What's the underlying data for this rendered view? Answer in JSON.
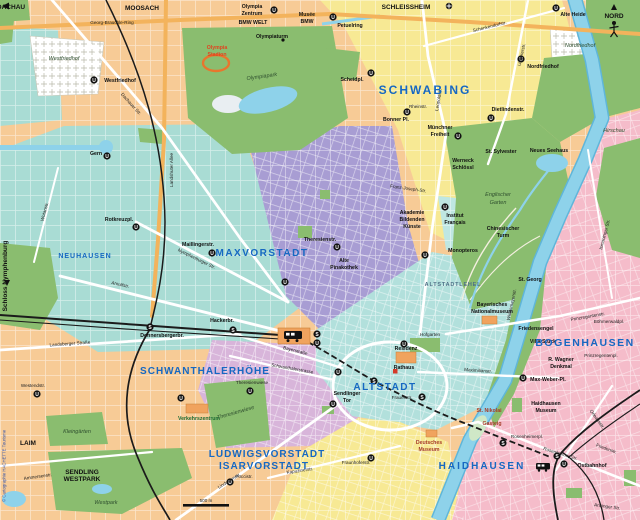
{
  "map": {
    "attribution": "© Cartographie HACHETTE Tourisme",
    "scale_label": "500 m",
    "compass_label": "NORD",
    "glyphs": {
      "u": "U",
      "s": "S"
    },
    "colors": {
      "base": "#f7cb96",
      "teal": "#a9dcd4",
      "cyan": "#b2e0dc",
      "purple": "#a89dd3",
      "yellow": "#f7e994",
      "pink": "#f5bcca",
      "lavender": "#d8b5da",
      "park": "#8abd6f",
      "water": "#8ed2ea",
      "rail": "#1b1b1b",
      "road_ring": "#f3b35c",
      "district_label": "#1668c2",
      "poi_red": "#e04420",
      "museum_red": "#a53c28"
    },
    "district_labels": [
      {
        "text": "MAXVORSTADT"
      },
      {
        "text": "SCHWABING"
      },
      {
        "text": "ALTSTADT"
      },
      {
        "text": "SCHWANTHALERHÖHE"
      },
      {
        "text": "LUDWIGSVORSTADT"
      },
      {
        "text": "ISARVORSTADT"
      },
      {
        "text": "HAIDHAUSEN"
      },
      {
        "text": "BOGENHAUSEN"
      },
      {
        "text": "NEUHAUSEN"
      },
      {
        "text": "ALTSTADTLEHEL"
      }
    ],
    "area_labels": [
      {
        "text": "MOOSACH"
      },
      {
        "text": "DACHAU"
      },
      {
        "text": "SCHLEISSHEIM"
      },
      {
        "text": "LAIM"
      },
      {
        "text": "SENDLING"
      },
      {
        "text": "WESTPARK"
      },
      {
        "text": "Westfriedhof"
      },
      {
        "text": "Nordfriedhof"
      },
      {
        "text": "Olympiapark"
      },
      {
        "text": "Englischer"
      },
      {
        "text": "Garten"
      },
      {
        "text": "Hirschau"
      },
      {
        "text": "Westpark"
      },
      {
        "text": "Kleingärten"
      },
      {
        "text": "Theresienwiese"
      },
      {
        "text": "Hofgarten"
      },
      {
        "text": "Schloss Nymphenburg"
      }
    ],
    "poi_labels": [
      {
        "text": "Olympia"
      },
      {
        "text": "Zentrum"
      },
      {
        "text": "BMW WELT"
      },
      {
        "text": "Musée"
      },
      {
        "text": "BMW"
      },
      {
        "text": "Olympiaturm"
      },
      {
        "text": "Olympia"
      },
      {
        "text": "Stadion"
      },
      {
        "text": "Petuelring"
      },
      {
        "text": "Alte Heide"
      },
      {
        "text": "Nordfriedhof"
      },
      {
        "text": "Scheidpl."
      },
      {
        "text": "Bonner Pl."
      },
      {
        "text": "Münchner"
      },
      {
        "text": "Freiheit"
      },
      {
        "text": "Dietlindenstr."
      },
      {
        "text": "St. Sylvester"
      },
      {
        "text": "Werneck"
      },
      {
        "text": "Schlössl"
      },
      {
        "text": "Neues Seehaus"
      },
      {
        "text": "Chinesischer"
      },
      {
        "text": "Turm"
      },
      {
        "text": "Monopteros"
      },
      {
        "text": "Akademie"
      },
      {
        "text": "Bildenden"
      },
      {
        "text": "Künste"
      },
      {
        "text": "Institut"
      },
      {
        "text": "Français"
      },
      {
        "text": "Alte"
      },
      {
        "text": "Pinakothek"
      },
      {
        "text": "Maillingerstr."
      },
      {
        "text": "Theresienstr."
      },
      {
        "text": "Rotkreuzpl."
      },
      {
        "text": "Gern"
      },
      {
        "text": "Westfriedhof"
      },
      {
        "text": "Hackerbr."
      },
      {
        "text": "Donnersbergerbr."
      },
      {
        "text": "Residenz"
      },
      {
        "text": "Rathaus"
      },
      {
        "text": "Sendlinger"
      },
      {
        "text": "Tor"
      },
      {
        "text": "Frauenstr."
      },
      {
        "text": "Bayerisches"
      },
      {
        "text": "Nationalmuseum"
      },
      {
        "text": "Friedensengel"
      },
      {
        "text": "Villa Stuck"
      },
      {
        "text": "R. Wagner"
      },
      {
        "text": "Denkmal"
      },
      {
        "text": "Max-Weber-Pl."
      },
      {
        "text": "St. Georg"
      },
      {
        "text": "Böhmerwaldpl."
      },
      {
        "text": "Prinzregentenpl."
      },
      {
        "text": "St. Nikolai"
      },
      {
        "text": "Gasteig"
      },
      {
        "text": "Deutsches"
      },
      {
        "text": "Museum"
      },
      {
        "text": "Haidhausen"
      },
      {
        "text": "Museum"
      },
      {
        "text": "Rosenheimerpl."
      },
      {
        "text": "Ostbahnhof"
      },
      {
        "text": "Verkehrszentrum"
      },
      {
        "text": "Theresienwiese"
      },
      {
        "text": "Westendstr."
      },
      {
        "text": "Poccistr."
      },
      {
        "text": "Fraunhoferstr."
      }
    ],
    "street_labels": [
      {
        "text": "Georg-Brauchle-Ring"
      },
      {
        "text": "Landshuter Allee"
      },
      {
        "text": "Dachauer Str."
      },
      {
        "text": "Nymphenburger Str."
      },
      {
        "text": "Arnulfstr."
      },
      {
        "text": "Landsberger Straße"
      },
      {
        "text": "Bayerstraße"
      },
      {
        "text": "Schwanthalerstrasse"
      },
      {
        "text": "Lindwurmstr."
      },
      {
        "text": "Leopoldstr."
      },
      {
        "text": "Ungererstr."
      },
      {
        "text": "Schenkendorfstr."
      },
      {
        "text": "Franz-Joseph-Str."
      },
      {
        "text": "Prinzregentenstr."
      },
      {
        "text": "Widenmayerstr."
      },
      {
        "text": "Maximilianstr."
      },
      {
        "text": "Rosenheimer Str."
      },
      {
        "text": "Orleansstr."
      },
      {
        "text": "Ismaninger Str."
      },
      {
        "text": "Rheinstr."
      },
      {
        "text": "Ammerseestr."
      },
      {
        "text": "Kapuzinerstr."
      },
      {
        "text": "Wotanstr."
      },
      {
        "text": "Friedenstr."
      },
      {
        "text": "Anzinger Str."
      }
    ]
  }
}
